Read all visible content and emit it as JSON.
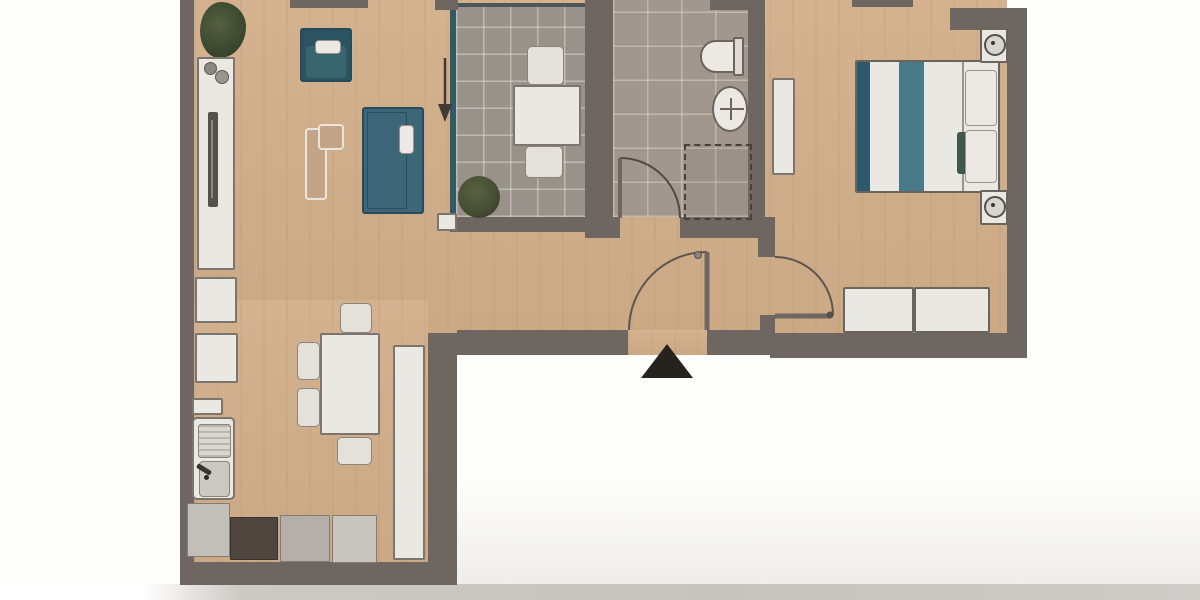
{
  "scene": {
    "type": "apartment-floor-plan-photo",
    "entrance_marker": "black-triangle-at-bottom",
    "no_visible_text": true
  },
  "colors": {
    "wall": "#6e6660",
    "floor": "#d2ae89",
    "tile_balcony": "#99928b",
    "tile_bath": "#a2978e",
    "teal_sofa": "#3d6678",
    "teal_band": "#4a7a8a",
    "teal_edge": "#2d5a6a",
    "teal_cushion": "#3f584f",
    "white_furniture": "#eae8e3",
    "furniture_border": "#7b756e",
    "gray_counter": "#b4afa9",
    "light_counter": "#c9c5bf",
    "dark_counter": "#4e463f",
    "plant_green": "#3d4a31",
    "accent_line": "#2f5a66",
    "entrance_marker": "#26221e",
    "photo_shadow": "#c7c3bf"
  },
  "rooms": [
    {
      "id": "living-room",
      "contents": [
        "plant",
        "sideboard-with-tv",
        "armchair",
        "sofa",
        "lounge-bench"
      ]
    },
    {
      "id": "balcony",
      "contents": [
        "bistro-table",
        "two-chairs",
        "potted-bush",
        "door-arrow"
      ]
    },
    {
      "id": "bathroom",
      "contents": [
        "toilet",
        "washbasin",
        "shower-dashed",
        "door-swing"
      ]
    },
    {
      "id": "bedroom",
      "contents": [
        "double-bed",
        "two-nightstands-with-lamps",
        "wall-shelf",
        "wardrobe",
        "door-swing"
      ]
    },
    {
      "id": "kitchen",
      "contents": [
        "counter-run",
        "sink-unit",
        "stove-dark",
        "tall-cabinet",
        "dining-table",
        "four-chairs"
      ]
    },
    {
      "id": "hallway",
      "contents": [
        "front-door-swing",
        "entrance-triangle"
      ]
    }
  ]
}
